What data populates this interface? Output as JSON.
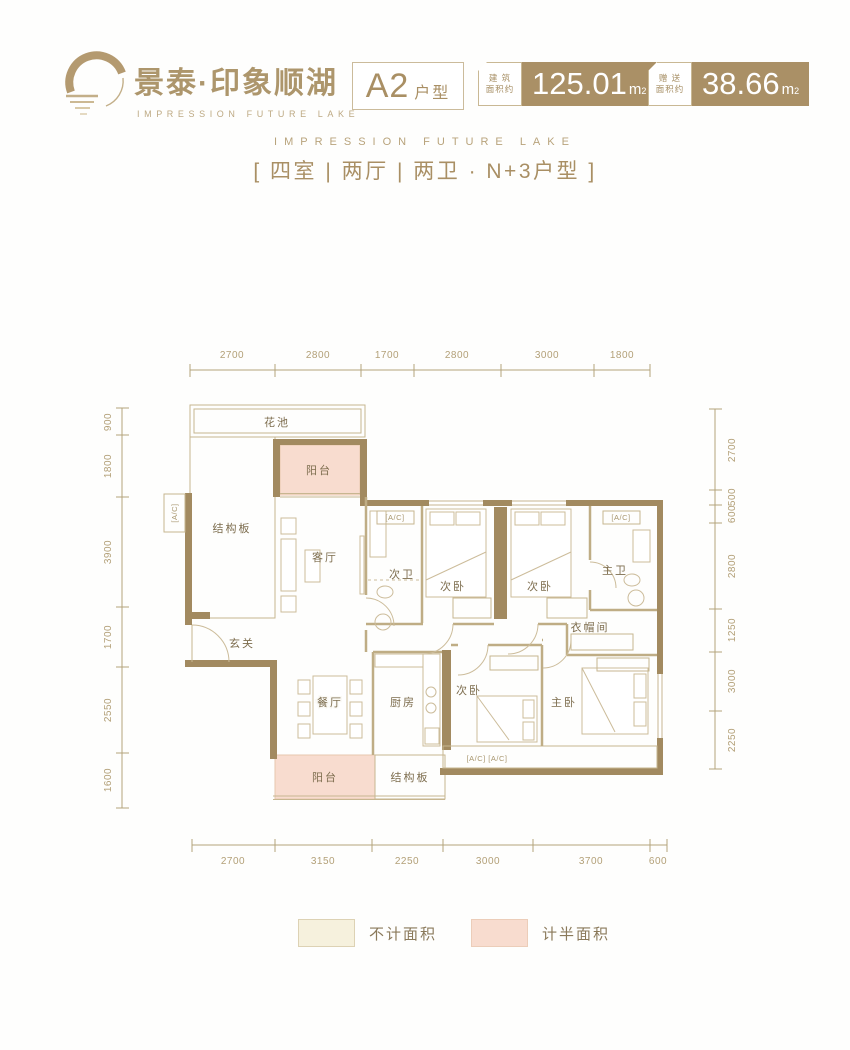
{
  "header": {
    "brand_cn": "景泰·印象顺湖",
    "brand_en": "IMPRESSION FUTURE LAKE",
    "unit_main": "A2",
    "unit_sub": "户型",
    "badges": [
      {
        "label_top": "建 筑",
        "label_bottom": "面积约",
        "value": "125.01",
        "unit_base": "m",
        "unit_sup": "2"
      },
      {
        "label_top": "赠 送",
        "label_bottom": "面积约",
        "value": "38.66",
        "unit_base": "m",
        "unit_sup": "2"
      }
    ]
  },
  "subheader": {
    "tagline": "IMPRESSION FUTURE LAKE",
    "spec": "[ 四室 | 两厅 | 两卫 · N+3户型 ]"
  },
  "plan": {
    "rooms": {
      "flower_bed": "花池",
      "slab": "结构板",
      "balcony": "阳台",
      "living": "客厅",
      "bath2": "次卫",
      "bed2": "次卧",
      "master_bath": "主卫",
      "cloakroom": "衣帽间",
      "foyer": "玄关",
      "dining": "餐厅",
      "kitchen": "厨房",
      "master_bed": "主卧"
    },
    "ac": {
      "single": "[A/C]",
      "double": "[A/C]  [A/C]"
    },
    "dims": {
      "top": [
        "2700",
        "2800",
        "1700",
        "2800",
        "3000",
        "1800"
      ],
      "bottom": [
        "2700",
        "3150",
        "2250",
        "3000",
        "3700",
        "600"
      ],
      "left": [
        "900",
        "1800",
        "3900",
        "1700",
        "2550",
        "1600"
      ],
      "right": [
        "2700",
        "500",
        "600",
        "2800",
        "1250",
        "3000",
        "2250"
      ]
    }
  },
  "legend": {
    "items": [
      {
        "label": "不计面积",
        "color": "#f6f1dd"
      },
      {
        "label": "计半面积",
        "color": "#f8dccf"
      }
    ]
  },
  "colors": {
    "accent": "#aa9066",
    "wall": "#a28a60",
    "uncounted": "#f6f1dd",
    "half_counted": "#f8dccf"
  }
}
